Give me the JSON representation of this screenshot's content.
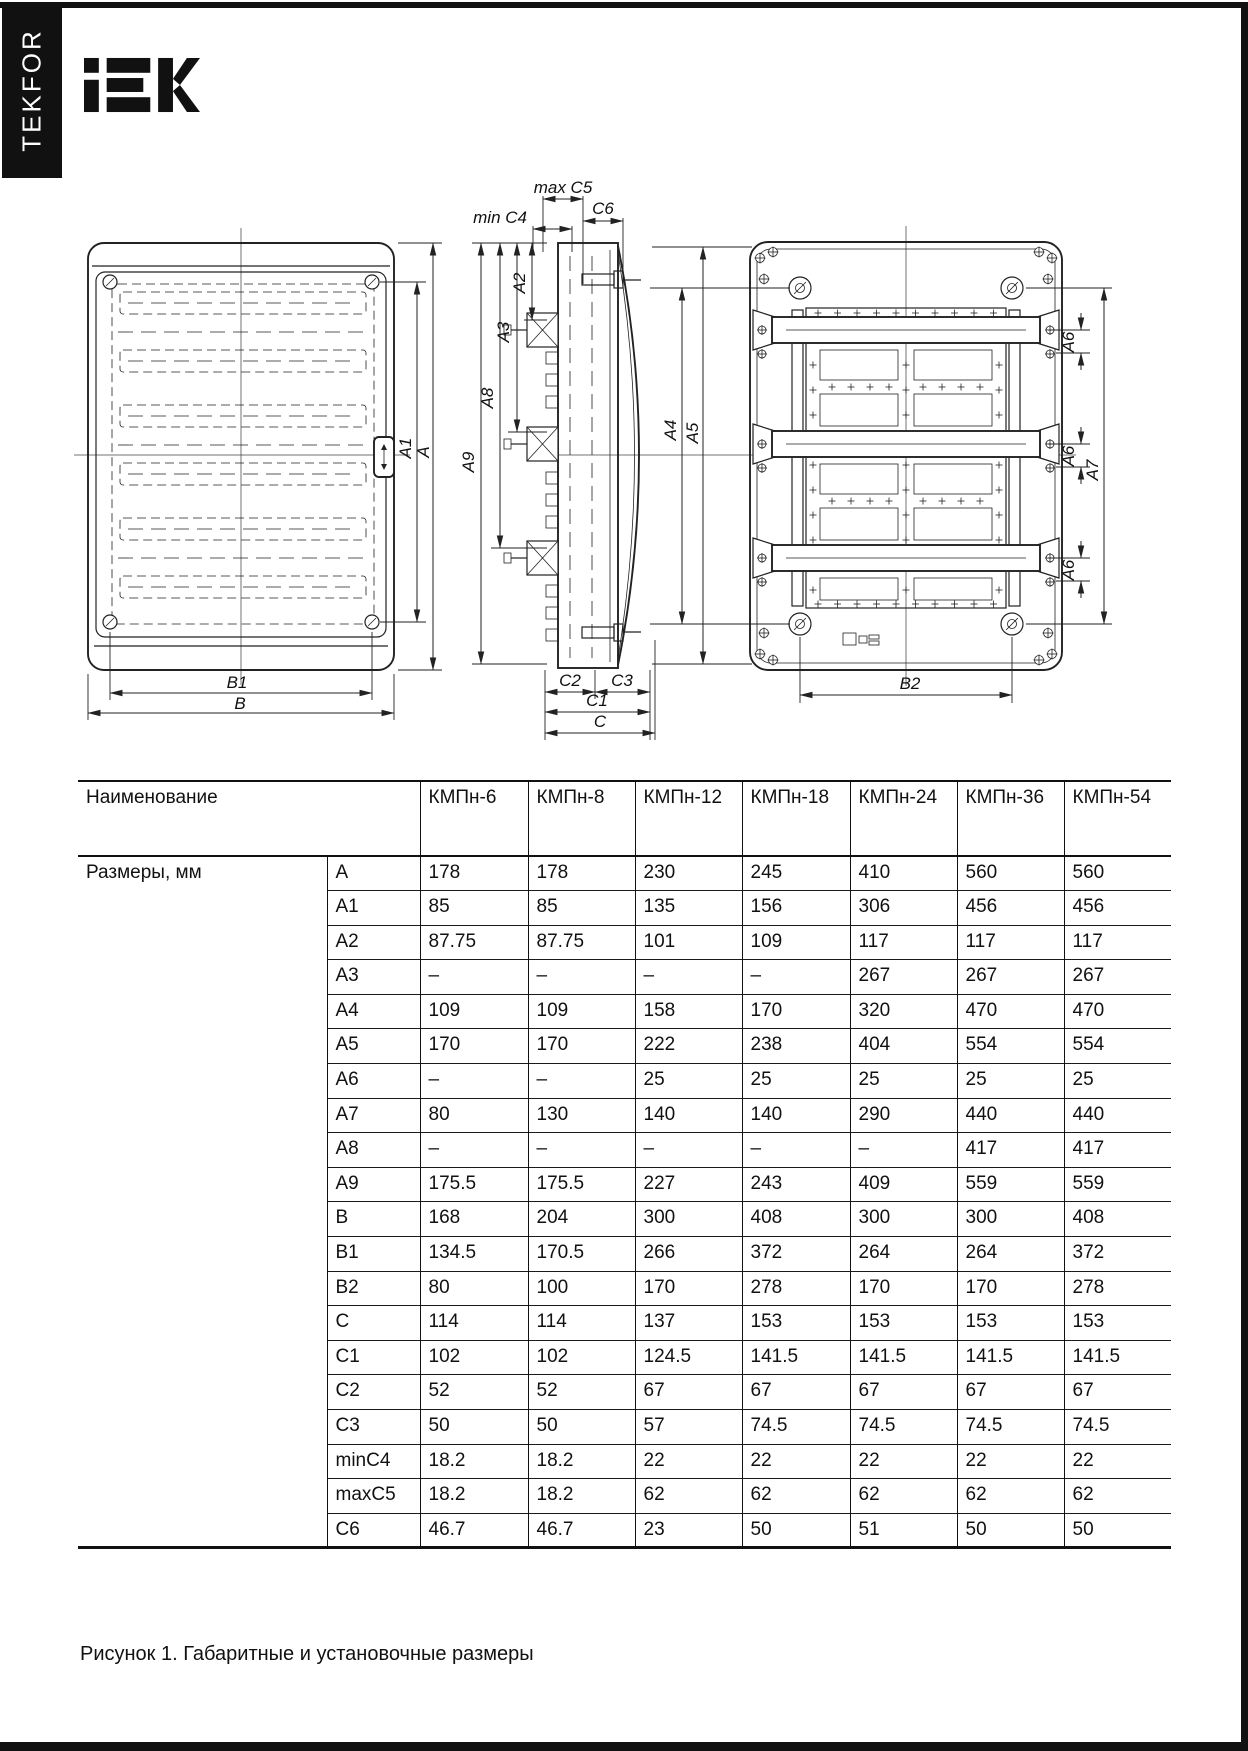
{
  "page": {
    "sidebar_brand": "TEKFOR",
    "logo_text": "IEK",
    "caption": "Рисунок 1. Габаритные и установочные размеры"
  },
  "drawings": {
    "front": {
      "a1": "A1",
      "a": "A",
      "b1": "B1",
      "b": "B"
    },
    "side": {
      "max_c5": "max C5",
      "min_c4": "min C4",
      "c6": "C6",
      "a2": "A2",
      "a3": "A3",
      "a8": "A8",
      "a9": "A9",
      "c2": "C2",
      "c3": "C3",
      "c1": "C1",
      "c": "C"
    },
    "back": {
      "a4": "A4",
      "a5": "A5",
      "a6": "A6",
      "a7": "A7",
      "b2": "B2"
    }
  },
  "table": {
    "name_header": "Наименование",
    "models": [
      "КМПн-6",
      "КМПн-8",
      "КМПн-12",
      "КМПн-18",
      "КМПн-24",
      "КМПн-36",
      "КМПн-54"
    ],
    "group_label": "Размеры, мм",
    "rows": [
      {
        "dim": "A",
        "values": [
          "178",
          "178",
          "230",
          "245",
          "410",
          "560",
          "560"
        ]
      },
      {
        "dim": "A1",
        "values": [
          "85",
          "85",
          "135",
          "156",
          "306",
          "456",
          "456"
        ]
      },
      {
        "dim": "A2",
        "values": [
          "87.75",
          "87.75",
          "101",
          "109",
          "117",
          "117",
          "117"
        ]
      },
      {
        "dim": "A3",
        "values": [
          "–",
          "–",
          "–",
          "–",
          "267",
          "267",
          "267"
        ]
      },
      {
        "dim": "A4",
        "values": [
          "109",
          "109",
          "158",
          "170",
          "320",
          "470",
          "470"
        ]
      },
      {
        "dim": "A5",
        "values": [
          "170",
          "170",
          "222",
          "238",
          "404",
          "554",
          "554"
        ]
      },
      {
        "dim": "A6",
        "values": [
          "–",
          "–",
          "25",
          "25",
          "25",
          "25",
          "25"
        ]
      },
      {
        "dim": "A7",
        "values": [
          "80",
          "130",
          "140",
          "140",
          "290",
          "440",
          "440"
        ]
      },
      {
        "dim": "A8",
        "values": [
          "–",
          "–",
          "–",
          "–",
          "–",
          "417",
          "417"
        ]
      },
      {
        "dim": "A9",
        "values": [
          "175.5",
          "175.5",
          "227",
          "243",
          "409",
          "559",
          "559"
        ]
      },
      {
        "dim": "B",
        "values": [
          "168",
          "204",
          "300",
          "408",
          "300",
          "300",
          "408"
        ]
      },
      {
        "dim": "B1",
        "values": [
          "134.5",
          "170.5",
          "266",
          "372",
          "264",
          "264",
          "372"
        ]
      },
      {
        "dim": "B2",
        "values": [
          "80",
          "100",
          "170",
          "278",
          "170",
          "170",
          "278"
        ]
      },
      {
        "dim": "C",
        "values": [
          "114",
          "114",
          "137",
          "153",
          "153",
          "153",
          "153"
        ]
      },
      {
        "dim": "C1",
        "values": [
          "102",
          "102",
          "124.5",
          "141.5",
          "141.5",
          "141.5",
          "141.5"
        ]
      },
      {
        "dim": "C2",
        "values": [
          "52",
          "52",
          "67",
          "67",
          "67",
          "67",
          "67"
        ]
      },
      {
        "dim": "C3",
        "values": [
          "50",
          "50",
          "57",
          "74.5",
          "74.5",
          "74.5",
          "74.5"
        ]
      },
      {
        "dim": "minC4",
        "values": [
          "18.2",
          "18.2",
          "22",
          "22",
          "22",
          "22",
          "22"
        ]
      },
      {
        "dim": "maxC5",
        "values": [
          "18.2",
          "18.2",
          "62",
          "62",
          "62",
          "62",
          "62"
        ]
      },
      {
        "dim": "C6",
        "values": [
          "46.7",
          "46.7",
          "23",
          "50",
          "51",
          "50",
          "50"
        ]
      }
    ]
  }
}
